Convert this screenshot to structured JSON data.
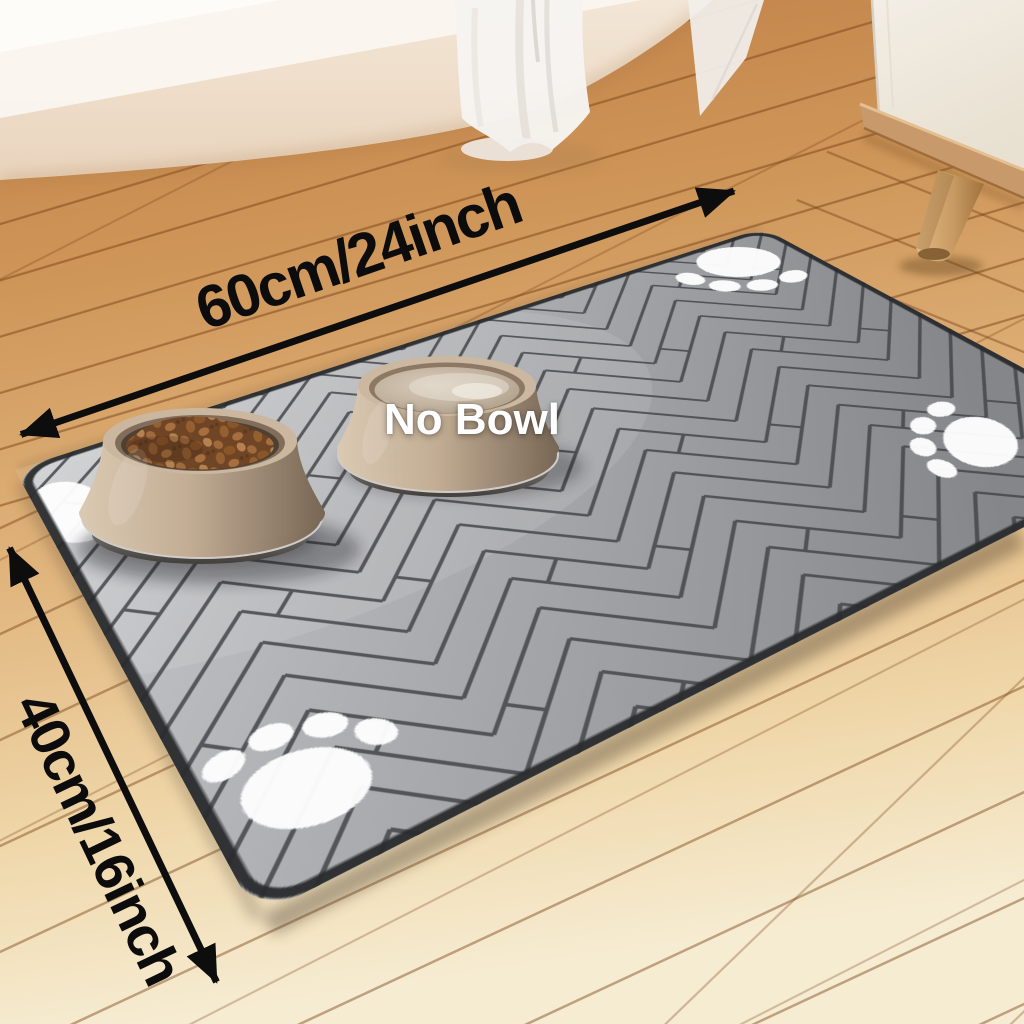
{
  "scene": {
    "annotations": {
      "width_label": "60cm/24inch",
      "height_label": "40cm/16inch",
      "no_bowl_label": "No Bowl"
    },
    "icons": {
      "paw_prints": "paw-print-icon",
      "dimension_arrows": "double-headed-arrow-icon"
    },
    "colors": {
      "arrow": "#0d0d0d",
      "dimension_text": "#0c0c0c",
      "no_bowl_text": "#ffffff",
      "mat_light": "#cfd0d2",
      "mat_mid": "#a9aaad",
      "mat_dark": "#85868a",
      "mat_line": "#45464a",
      "mat_edge": "#292a2c",
      "paw_white": "#fdfdfd",
      "floor_warm": "#bf7f47",
      "floor_pale": "#f6ecd2",
      "wall_cream": "#efe0cd",
      "bowl_tan": "#c2ad94",
      "kibble_brown": "#6f4526",
      "cabinet_white": "#f3eee6",
      "wood_leg": "#c79a63"
    }
  }
}
